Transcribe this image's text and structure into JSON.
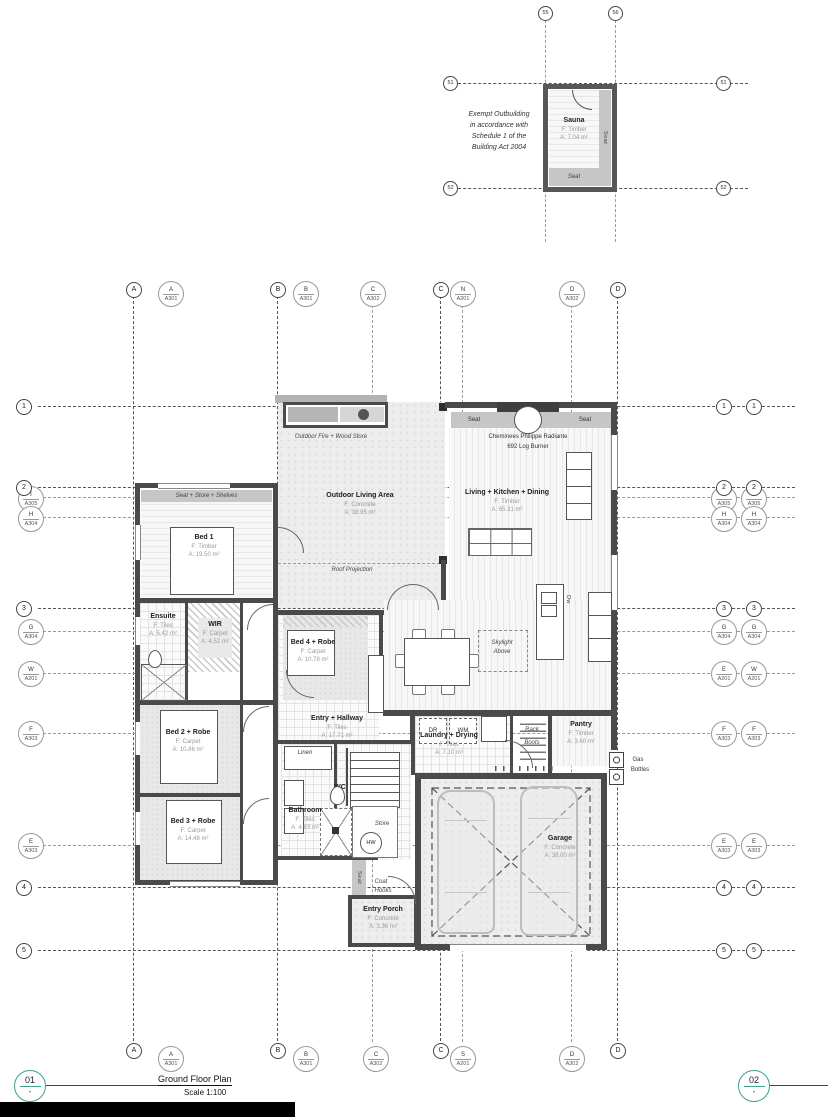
{
  "outbuilding": {
    "note_lines": [
      "Exempt Outbuilding",
      "in accordance with",
      "Schedule 1 of the",
      "Building Act 2004"
    ],
    "room": {
      "name": "Sauna",
      "floor": "F: Timber",
      "area": "A: 7.04 m²"
    },
    "seat_right": "Seat",
    "seat_bottom": "Seat"
  },
  "grid": {
    "circles": {
      "r1": "1",
      "r2": "2",
      "r3": "3",
      "r4": "4",
      "r5": "5",
      "cA": "A",
      "cB": "B",
      "cC": "C",
      "cD": "D",
      "s1": "51",
      "s2": "52",
      "s5": "55",
      "s6": "56"
    },
    "sections": {
      "A301A": {
        "t": "A",
        "s": "A301"
      },
      "A301B": {
        "t": "B",
        "s": "A301"
      },
      "A302C": {
        "t": "C",
        "s": "A302"
      },
      "A302D": {
        "t": "D",
        "s": "A302"
      },
      "A201N": {
        "t": "N",
        "s": "A201"
      },
      "A201S": {
        "t": "S",
        "s": "A201"
      },
      "A305I": {
        "t": "I",
        "s": "A305"
      },
      "A304H": {
        "t": "H",
        "s": "A304"
      },
      "A304G": {
        "t": "G",
        "s": "A304"
      },
      "A201W": {
        "t": "W",
        "s": "A201"
      },
      "A201E": {
        "t": "E",
        "s": "A201"
      },
      "A303F": {
        "t": "F",
        "s": "A303"
      },
      "A303E": {
        "t": "E",
        "s": "A303"
      }
    }
  },
  "rooms": {
    "bed1": {
      "name": "Bed 1",
      "floor": "F: Timber",
      "area": "A: 19.50 m²"
    },
    "outdoor": {
      "name": "Outdoor Living Area",
      "floor": "F: Concrete",
      "area": "A: 38.95 m²"
    },
    "living": {
      "name": "Living + Kitchen + Dining",
      "floor": "F: Timber",
      "area": "A: 65.31 m²"
    },
    "ensuite": {
      "name": "Ensuite",
      "floor": "F: Tiles",
      "area": "A: 5.42 m²"
    },
    "wir": {
      "name": "WIR",
      "floor": "F: Carpet",
      "area": "A: 4.52 m²"
    },
    "bed4": {
      "name": "Bed 4 + Robe",
      "floor": "F: Carpet",
      "area": "A: 10.78 m²"
    },
    "entry": {
      "name": "Entry + Hallway",
      "floor": "F: Tiles",
      "area": "A: 17.71 m²"
    },
    "laundry": {
      "name": "Laundry + Drying",
      "floor": "F: Tiles",
      "area": "A: 7.10 m²"
    },
    "pantry": {
      "name": "Pantry",
      "floor": "F: Timber",
      "area": "A: 3.60 m²"
    },
    "garage": {
      "name": "Garage",
      "floor": "F: Concrete",
      "area": "A: 38.00 m²"
    },
    "bed2": {
      "name": "Bed 2 + Robe",
      "floor": "F: Carpet",
      "area": "A: 10.86 m²"
    },
    "bed3": {
      "name": "Bed 3 + Robe",
      "floor": "F: Carpet",
      "area": "A: 14.48 m²"
    },
    "bathroom": {
      "name": "Bathroom",
      "floor": "F: Tiles",
      "area": "A: 4.83 m²"
    },
    "porch": {
      "name": "Entry Porch",
      "floor": "F: Concrete",
      "area": "A: 3.36 m²"
    }
  },
  "labels": {
    "seat_store_shelves": "Seat + Store + Shelves",
    "outdoor_fire": "Outdoor Fire + Wood Store",
    "roof_projection": "Roof Projection",
    "seat": "Seat",
    "cheminees": "Cheminees Philippe Radiante",
    "log_burner": "692 Log Burner",
    "skylight1": "Skylight",
    "skylight2": "Above",
    "shelving": "Shelving",
    "dw": "Dw",
    "dr": "DR",
    "wm": "WM",
    "rack": "Rack",
    "boots": "Boots",
    "ski_hooks": "Ski Hooks",
    "gas": "Gas",
    "bottles": "Bottles",
    "linen": "Linen",
    "wc": "WC",
    "store": "Store",
    "hw": "HW",
    "coat": "Coat",
    "hooks": "Hooks"
  },
  "titleblock": {
    "d1": "01",
    "d1b": "-",
    "title": "Ground Floor Plan",
    "scale": "Scale 1:100",
    "d2": "02",
    "d2b": "-"
  }
}
